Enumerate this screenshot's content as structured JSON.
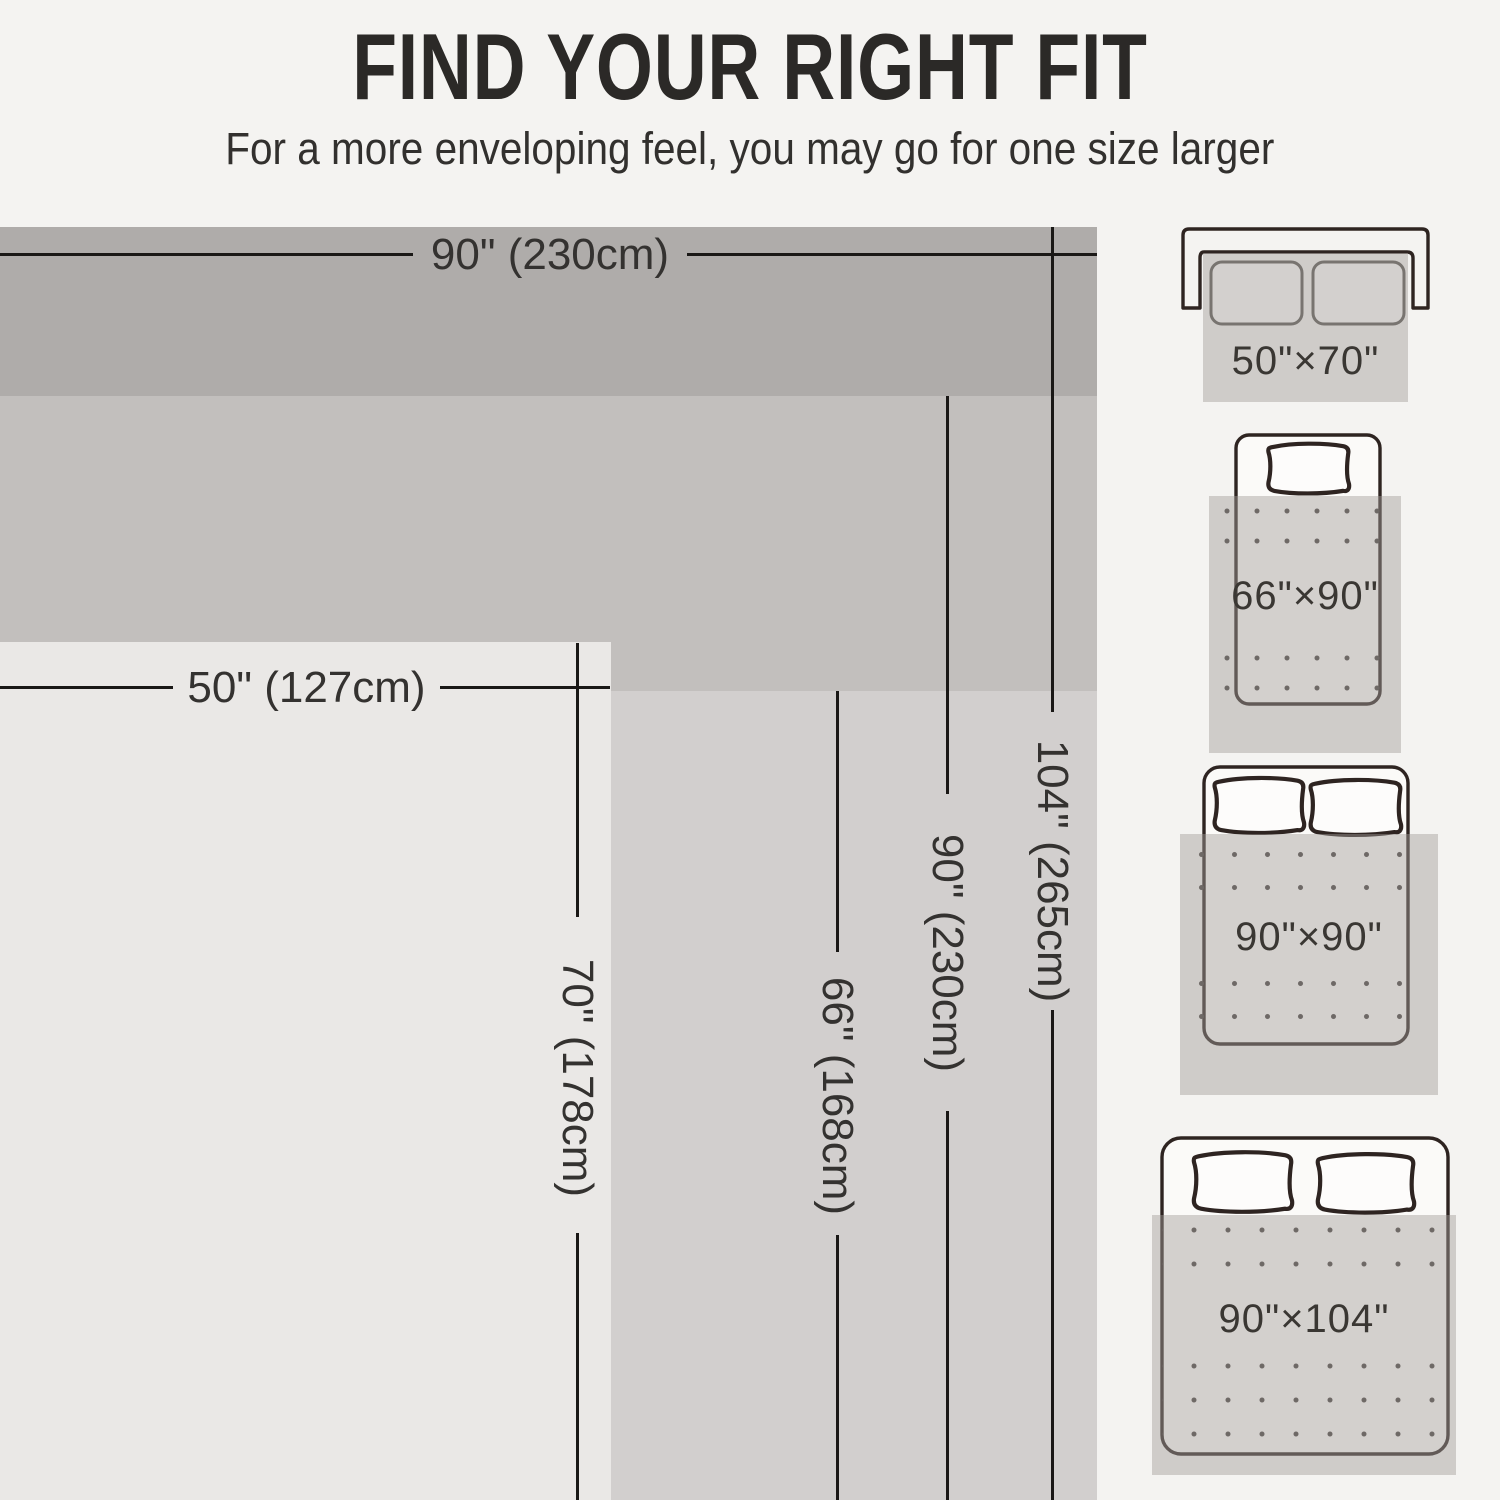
{
  "header": {
    "title": "FIND YOUR RIGHT FIT",
    "subtitle": "For a more enveloping feel, you may go for one size larger"
  },
  "diagram": {
    "h_dims": [
      {
        "label": "90\" (230cm)"
      },
      {
        "label": "50\" (127cm)"
      }
    ],
    "v_dims": [
      {
        "label": "104\" (265cm)"
      },
      {
        "label": "90\" (230cm)"
      },
      {
        "label": "66\" (168cm)"
      },
      {
        "label": "70\" (178cm)"
      }
    ],
    "layers": [
      {
        "name": "90x104",
        "color": "#afacaa"
      },
      {
        "name": "90x90",
        "color": "#c2bfbd"
      },
      {
        "name": "66x90",
        "color": "#d2cfce"
      },
      {
        "name": "50x70",
        "color": "#eae8e6"
      }
    ]
  },
  "size_options": [
    {
      "icon": "sofa-icon",
      "label": "50\"×70\""
    },
    {
      "icon": "single-bed-icon",
      "label": "66\"×90\""
    },
    {
      "icon": "double-bed-icon",
      "label": "90\"×90\""
    },
    {
      "icon": "large-bed-icon",
      "label": "90\"×104\""
    }
  ],
  "palette": {
    "background": "#f4f3f1",
    "dimension_line": "#1a1816",
    "dimension_text": "#343230",
    "illustration_outline": "#2e2421",
    "throw_overlay": "rgba(161,157,154,0.45)"
  }
}
